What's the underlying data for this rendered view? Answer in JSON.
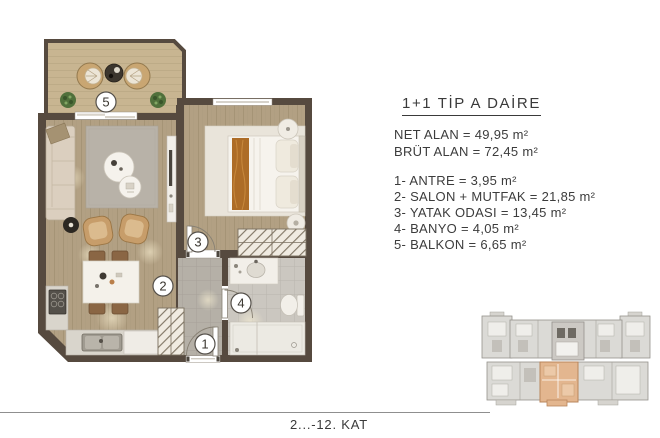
{
  "info_panel": {
    "title": "1+1 TİP A DAİRE",
    "area_lines": [
      {
        "label": "NET ALAN",
        "value": "49,95 m²",
        "line": "NET ALAN = 49,95 m²"
      },
      {
        "label": "BRÜT ALAN",
        "value": "72,45 m²",
        "line": "BRÜT ALAN = 72,45 m²"
      }
    ],
    "rooms": [
      {
        "number": "1",
        "name": "ANTRE",
        "value": "3,95 m²",
        "line": "1- ANTRE = 3,95 m²"
      },
      {
        "number": "2",
        "name": "SALON + MUTFAK",
        "value": "21,85 m²",
        "line": "2- SALON + MUTFAK = 21,85 m²"
      },
      {
        "number": "3",
        "name": "YATAK ODASI",
        "value": "13,45 m²",
        "line": "3- YATAK ODASI = 13,45 m²"
      },
      {
        "number": "4",
        "name": "BANYO",
        "value": "4,05 m²",
        "line": "4- BANYO = 4,05 m²"
      },
      {
        "number": "5",
        "name": "BALKON",
        "value": "6,65 m²",
        "line": "5- BALKON = 6,65 m²"
      }
    ]
  },
  "plan": {
    "room_numbers": [
      "1",
      "2",
      "3",
      "4",
      "5"
    ]
  },
  "footer": {
    "floor_label": "2...-12. KAT"
  },
  "colors": {
    "wall": "#564a3f",
    "wood_floor": "#b2a083",
    "balcony_floor": "#c8b591",
    "entry_tile": "#b5b0a7",
    "bath_tile": "#cbc7c0",
    "bed_runner": "#ad6c26",
    "keyplan_unit_highlight": "#e3b68f",
    "text": "#3b3b3b"
  }
}
